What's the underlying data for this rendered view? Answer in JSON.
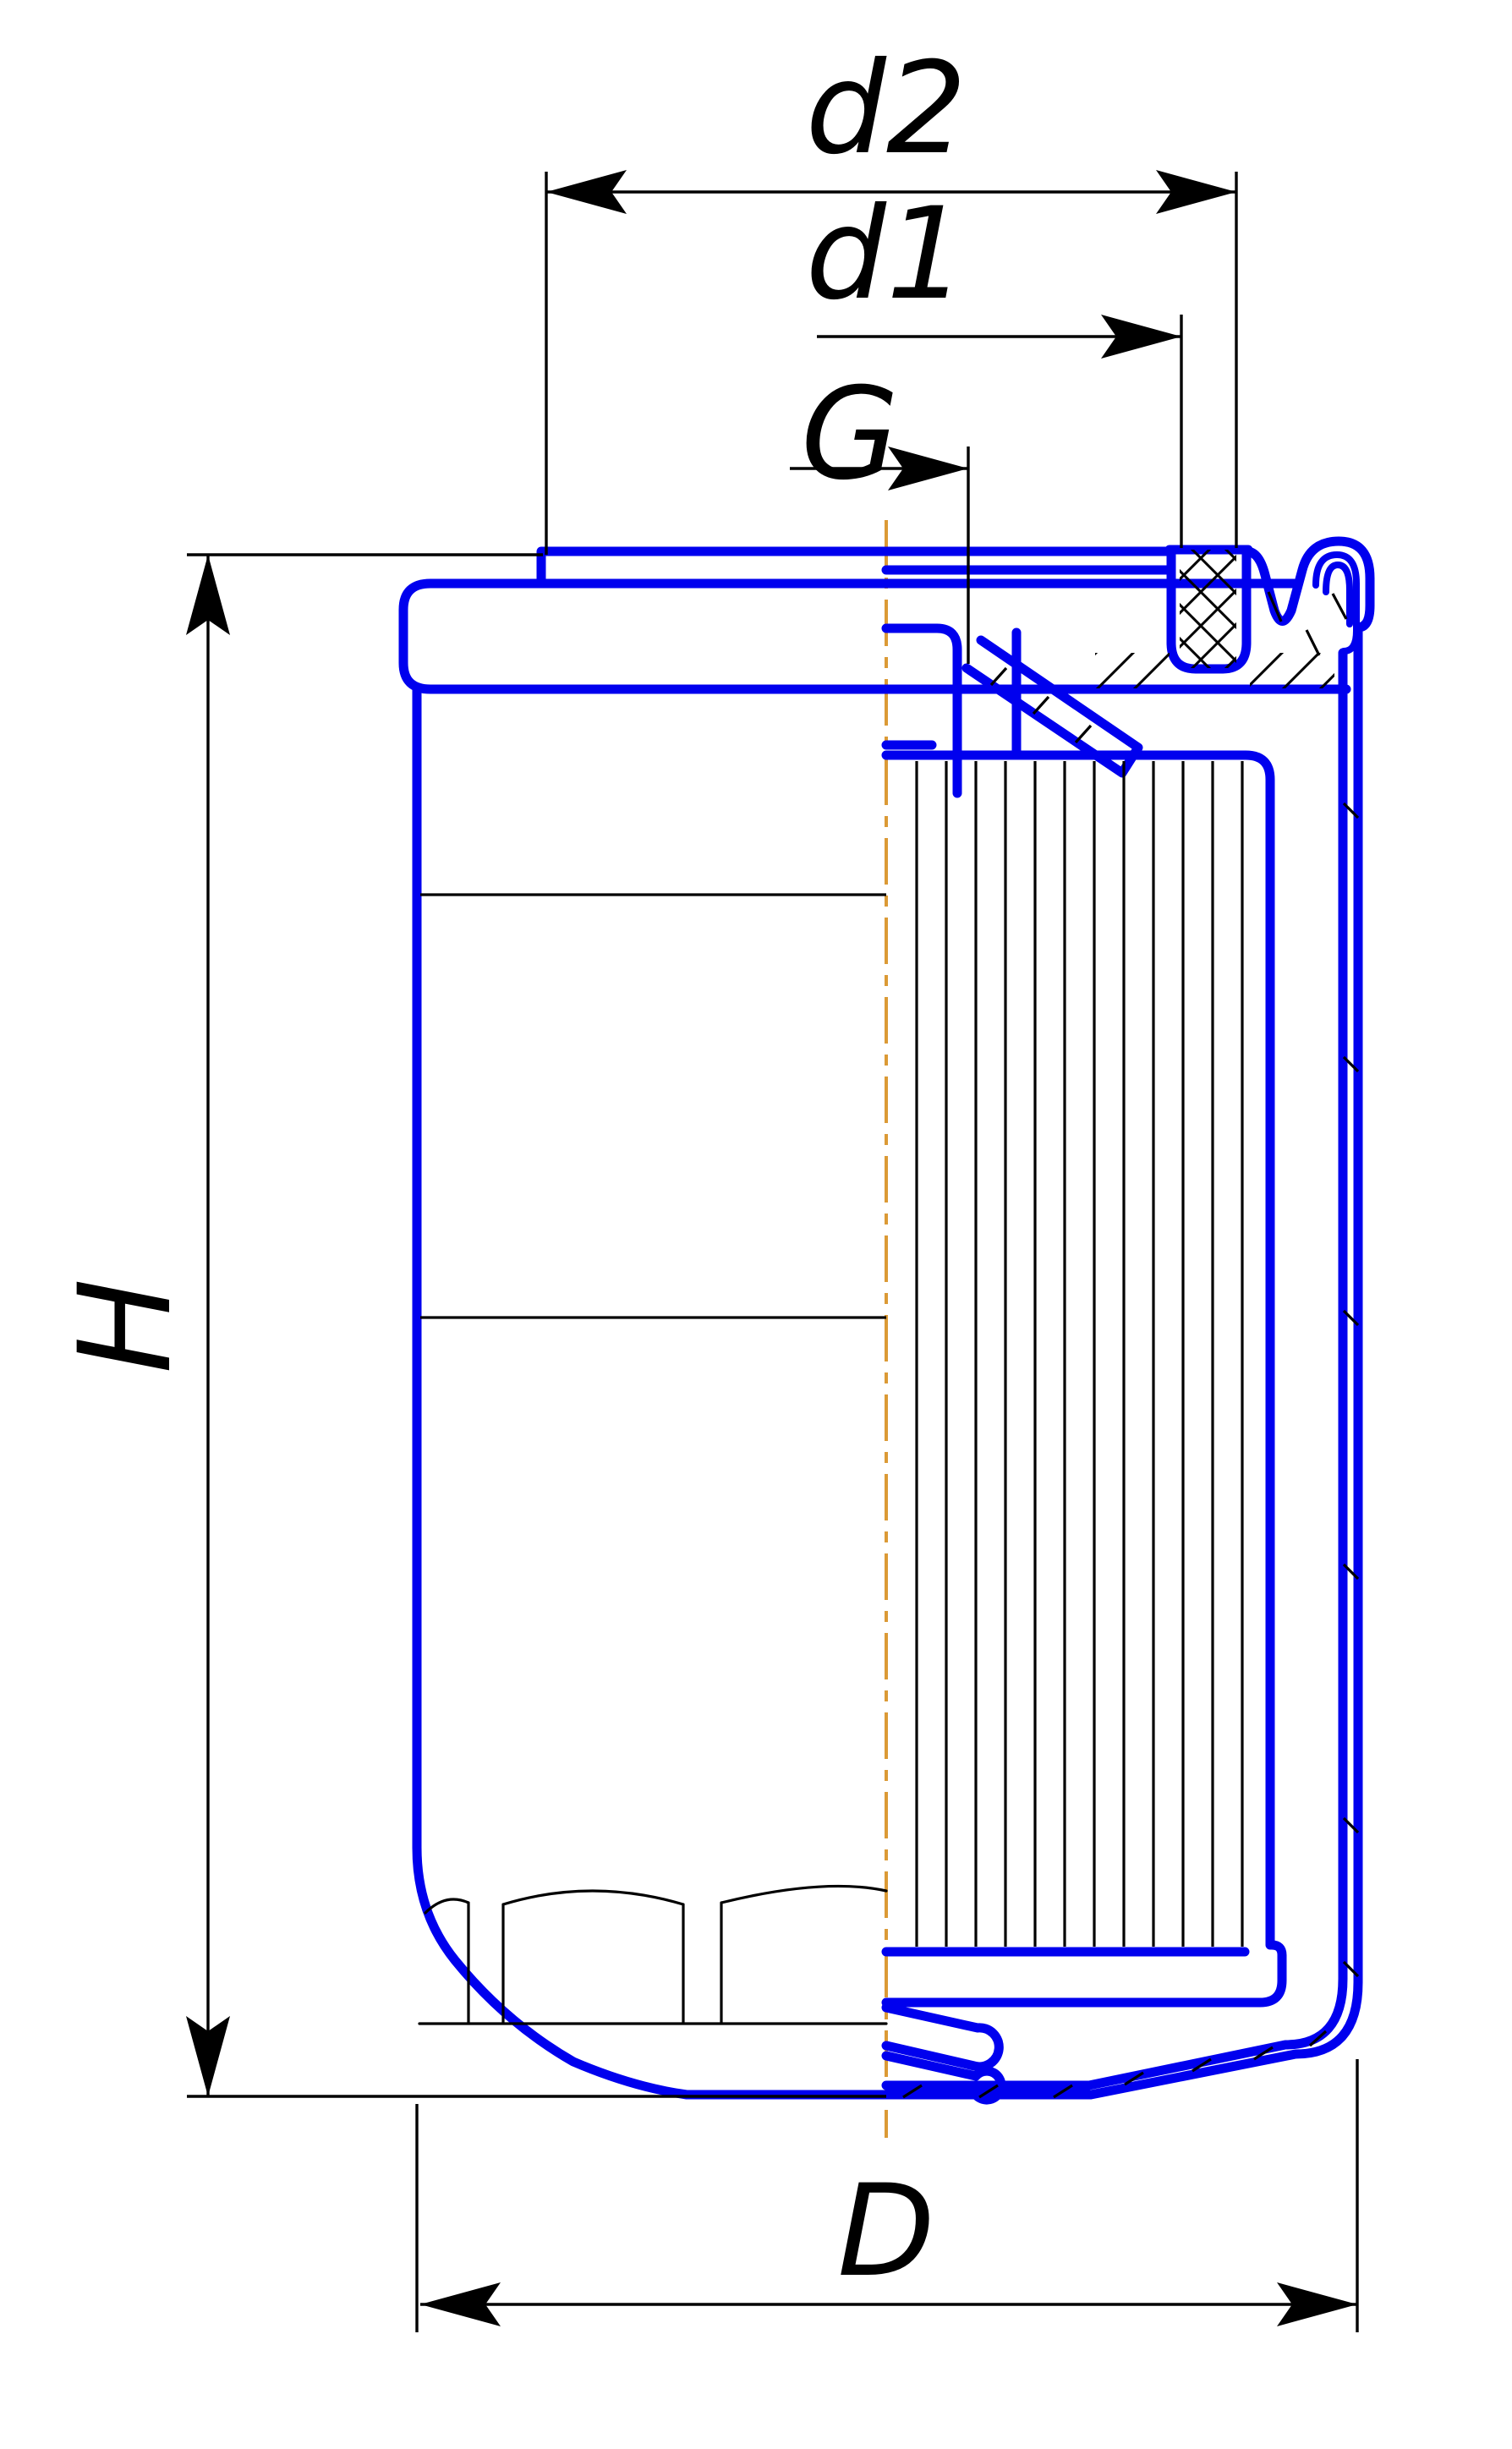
{
  "drawing": {
    "type": "engineering-cross-section",
    "subject": "spin-on oil filter",
    "labels": {
      "d2": "d2",
      "d1": "d1",
      "G": "G",
      "H": "H",
      "D": "D"
    },
    "colors": {
      "structure_blue": "#0000EE",
      "centerline_orange": "#DB9A36",
      "line_black": "#000000",
      "background": "#FFFFFF"
    }
  }
}
